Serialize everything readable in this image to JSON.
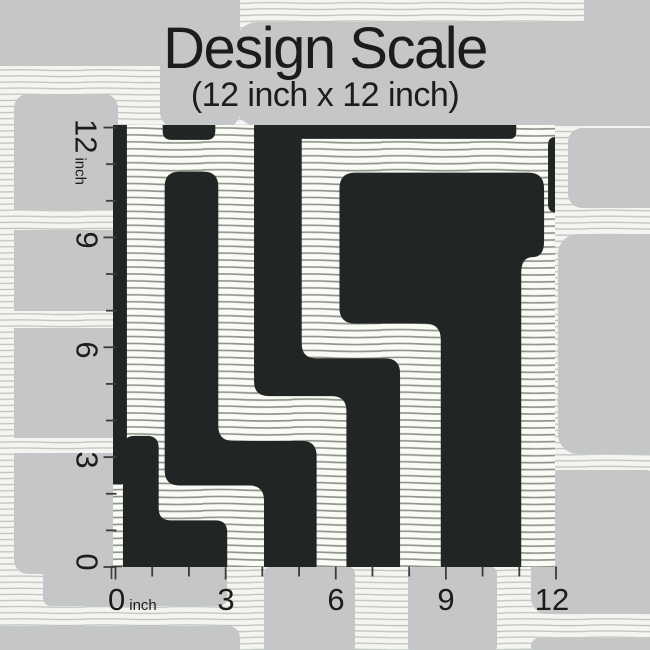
{
  "title": "Design Scale",
  "subtitle": "(12 inch x 12 inch)",
  "rulers": {
    "unit": "inch",
    "left_labels": [
      "12",
      "9",
      "6",
      "3",
      "0"
    ],
    "bottom_labels": [
      "0",
      "3",
      "6",
      "9",
      "12"
    ]
  },
  "swatch": {
    "alt": "Black and off-white geometric maze wallpaper swatch with hand-drawn horizontal stripes, shown at 12 inch by 12 inch design scale"
  },
  "palette": {
    "pattern_black": "#212625",
    "background_gray": "#c5c6c8",
    "swatch_ground": "#fbfbf6",
    "swatch_stripe": "#868c84",
    "page_ground": "#f4f5f1",
    "page_stripe": "#bfc4be",
    "text": "#1c1c1c",
    "tick": "#3c3c3c"
  }
}
